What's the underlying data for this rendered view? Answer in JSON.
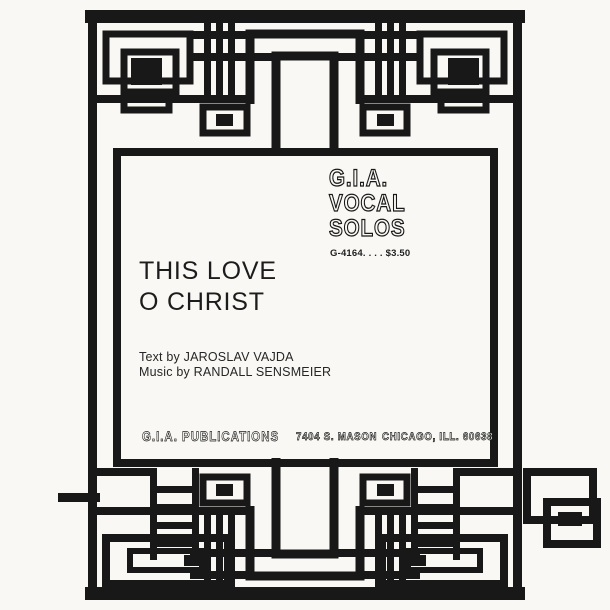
{
  "series": {
    "lines": [
      "G.I.A.",
      "VOCAL",
      "SOLOS"
    ],
    "catalog": "G-4164. . . . $3.50"
  },
  "title": {
    "lines": [
      "THIS LOVE",
      "O CHRIST"
    ]
  },
  "credits": {
    "text_by": "Text by JAROSLAV VAJDA",
    "music_by": "Music by RANDALL SENSMEIER"
  },
  "publisher": {
    "name": "G.I.A. PUBLICATIONS",
    "address": "7404 S. MASON",
    "city": "CHICAGO, ILL. 60638"
  },
  "colors": {
    "ink": "#181818",
    "paper": "#f9f8f4"
  }
}
